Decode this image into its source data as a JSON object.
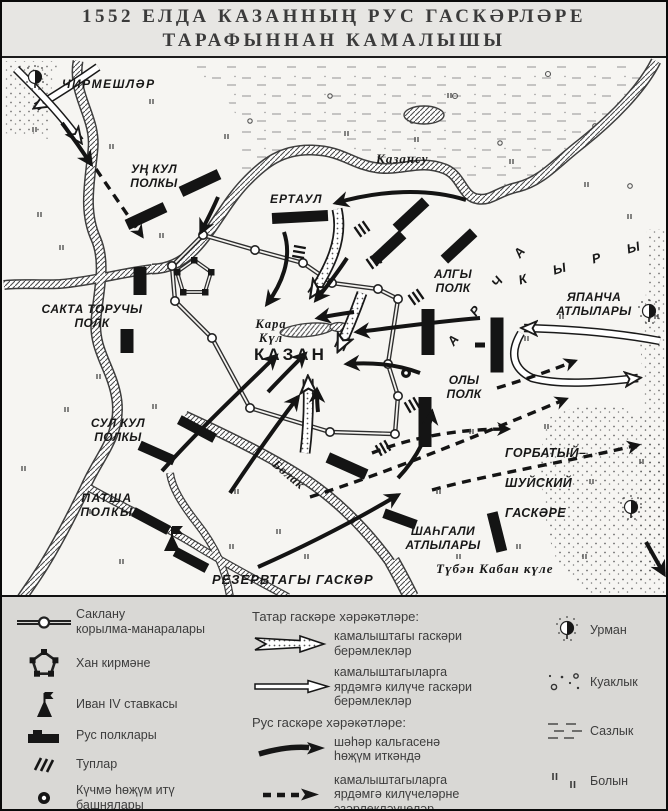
{
  "title": {
    "line1": "1552 ЕЛДА КАЗАННЫҢ РУС ГАСКӘРЛӘРЕ",
    "line2": "ТАРАФЫННАН КАМАЛЫШЫ"
  },
  "map_labels": {
    "chirmeshler": "ЧИРМЕШЛӘР",
    "un_kul_polky": "УҢ КУЛ\nПОЛКЫ",
    "kazansu": "Казансу",
    "ertaul": "ЕРТАУЛ",
    "algy_polk": "АЛГЫ\nПОЛК",
    "sakta_toruchy_polk": "САКТА ТОРУЧЫ\nПОЛК",
    "archa": "А Р Ч А",
    "kyry": "К Ы Р Ы",
    "japancha_atlylary": "ЯПАНЧА\nАТЛЫЛАРЫ",
    "kara_kul": "Кара\nКүл",
    "kazan": "КАЗАН",
    "oly_polk": "ОЛЫ\nПОЛК",
    "sul_kul_polky": "СУЛ КУЛ\nПОЛКЫ",
    "gorbatyj_shujskij_gaskere": "ГОРБАТЫЙ–\nШУЙСКИЙ\nГАСКӘРЕ",
    "patsha_polky": "ПАТША\nПОЛКЫ",
    "shahgali_atlylary": "ШАҺГАЛИ\nАТЛЫЛАРЫ",
    "bolak": "Болак",
    "rezervtagy_gasker": "РЕЗЕРВТАГЫ ГАСКӘР",
    "tuben_kaban_kule": "Түбән Кабан күле"
  },
  "legend": {
    "left": [
      {
        "symbol": "wall-towers-icon",
        "label": "Саклану\nкорылма-манаралары"
      },
      {
        "symbol": "khan-fortress-icon",
        "label": "Хан кирмәне"
      },
      {
        "symbol": "ivan-hq-flag-icon",
        "label": "Иван IV ставкасы"
      },
      {
        "symbol": "rus-regiment-icon",
        "label": "Рус полклары"
      },
      {
        "symbol": "cannons-icon",
        "label": "Туплар"
      },
      {
        "symbol": "siege-tower-icon",
        "label": "Күчмә һөҗүм итү\nбашнялары"
      }
    ],
    "tatar_header": "Татар гаскәре хәрәкәтләре:",
    "tatar": [
      {
        "symbol": "stippled-arrow-icon",
        "label": "камалыштагы гаскәри\nберәмлекләр"
      },
      {
        "symbol": "open-arrow-icon",
        "label": "камалыштагыларга\nярдәмгә килүче гаскәри\nберәмлекләр"
      }
    ],
    "rus_header": "Рус гаскәре хәрәкәтләре:",
    "rus": [
      {
        "symbol": "solid-arrow-icon",
        "label": "шәһәр кальгасенә\nһөҗүм иткәндә"
      },
      {
        "symbol": "dashed-arrow-icon",
        "label": "камалыштагыларга\nярдәмгә килүчеләрне\nэзәрлекләүчеләр"
      }
    ],
    "terrain": [
      {
        "symbol": "forest-icon",
        "label": "Урман"
      },
      {
        "symbol": "shrubs-icon",
        "label": "Куаклык"
      },
      {
        "symbol": "swamp-icon",
        "label": "Сазлык"
      },
      {
        "symbol": "meadow-icon",
        "label": "Болын"
      }
    ]
  },
  "colors": {
    "ink": "#161616",
    "paper": "#f4f3f0",
    "legend_bg": "#d9d8d5",
    "title_bg": "#e7e6e3"
  }
}
